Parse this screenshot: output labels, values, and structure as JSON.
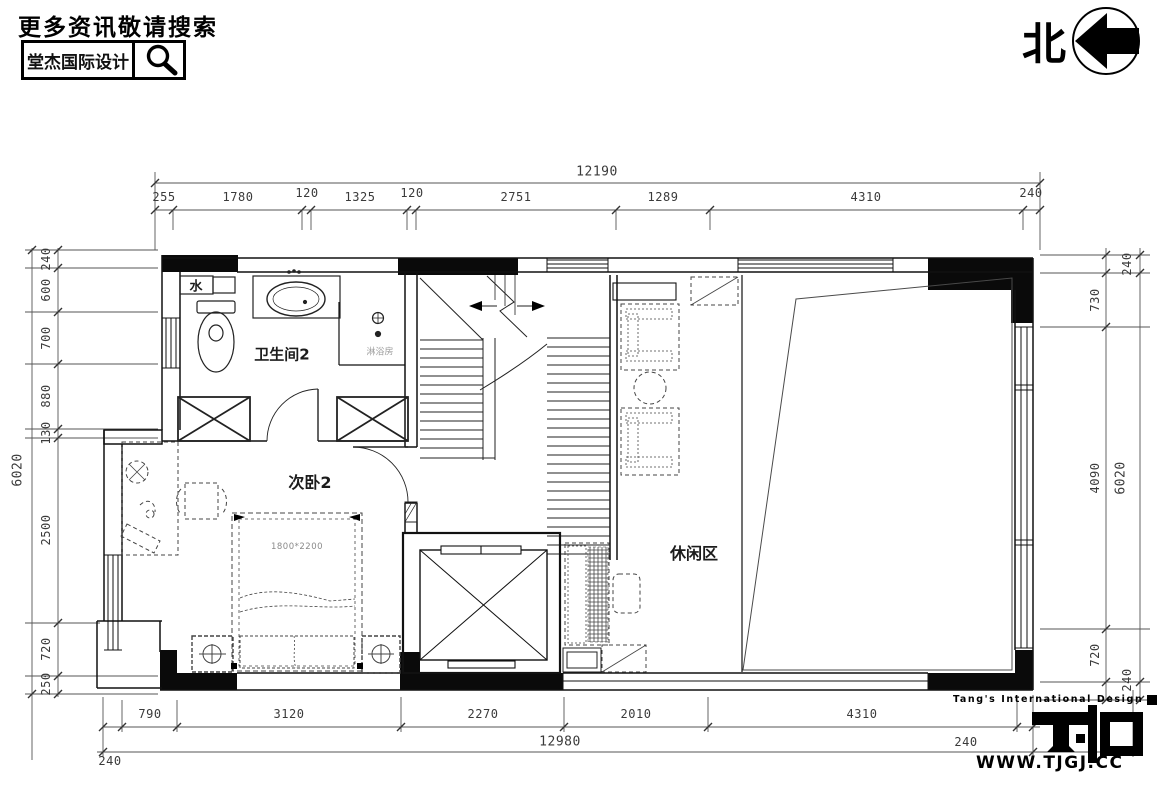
{
  "header": {
    "tagline": "更多资讯敬请搜索",
    "brand": "堂杰国际设计"
  },
  "compass": {
    "label": "北"
  },
  "dimensions": {
    "top": {
      "total": "12190",
      "segments": [
        "255",
        "1780",
        "120",
        "1325",
        "120",
        "2751",
        "1289",
        "4310",
        "240"
      ]
    },
    "bottom": {
      "total": "12980",
      "segments": [
        "790",
        "3120",
        "2270",
        "2010",
        "4310"
      ],
      "left_wall": "240",
      "right_wall": "240"
    },
    "left": {
      "total": "6020",
      "segments": [
        "240",
        "600",
        "700",
        "880",
        "130",
        "2500",
        "720",
        "250"
      ]
    },
    "right": {
      "total": "6020",
      "segments": [
        "730",
        "4090",
        "720"
      ],
      "wall_top": "240",
      "wall_bottom": "240"
    }
  },
  "rooms": {
    "bathroom": "卫生间2",
    "shower": "淋浴房",
    "bedroom": "次卧2",
    "leisure": "休闲区",
    "water_meter": "水",
    "bed_size": "1800*2200"
  },
  "logo": {
    "company": "Tang's International Design",
    "website": "WWW.TJGJ.CC"
  }
}
